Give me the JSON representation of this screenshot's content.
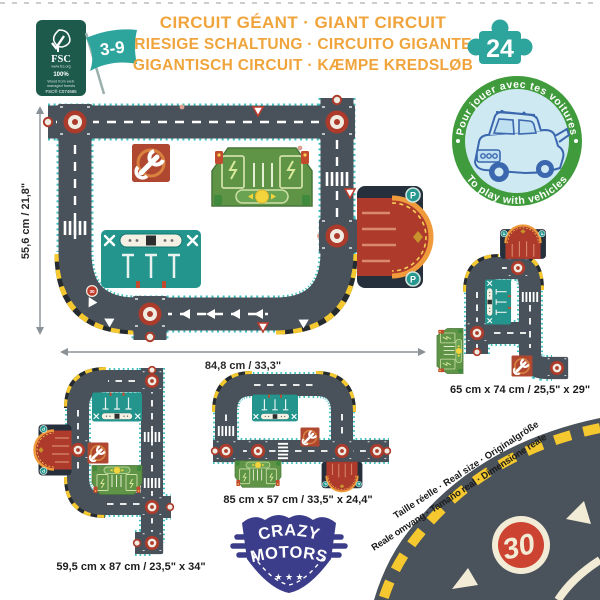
{
  "header": {
    "titles": {
      "line1": "CIRCUIT GÉANT · GIANT CIRCUIT",
      "line2": "RIESIGE SCHALTUNG · CIRCUITO GIGANTE",
      "line3": "GIGANTISCH CIRCUIT · KÆMPE KREDSLØB"
    },
    "age_range": "3-9",
    "piece_count": "24",
    "fsc": {
      "brand": "FSC",
      "site": "www.fsc.org",
      "percent": "100%",
      "claim1": "Wood from well-",
      "claim2": "managed forests",
      "license": "FSC® C074685"
    }
  },
  "vehicles_badge": {
    "top_text": "Pour jouer avec tes voitures",
    "bottom_text": "To play with vehicles"
  },
  "main_circuit": {
    "height_label": "55,6 cm / 21,8\"",
    "width_label": "84,8 cm / 33,3\""
  },
  "variants": {
    "right": {
      "size_label": "65 cm x 74 cm / 25,5\" x 29\""
    },
    "middle": {
      "size_label": "85 cm x 57 cm / 33,5\" x 24,4\""
    },
    "left": {
      "size_label": "59,5 cm x 87 cm / 23,5\" x 34\""
    }
  },
  "tiles": {
    "parking_label": "P",
    "curve_speed_sign": "30"
  },
  "real_size_banner": {
    "line1": "Taille réelle · Real size · Originalgröße",
    "line2": "Reale omvang · Tamaño real · Dimensione reale",
    "speed_sign": "30"
  },
  "logo": {
    "line1": "CRAZY",
    "line2": "MOTORS",
    "stars": "★ ★ ★"
  },
  "colors": {
    "title_orange": "#f0a43c",
    "teal": "#2da59d",
    "badge_green": "#3f9b3b",
    "road": "#49525b",
    "road_edge_teal": "#3fc1bd",
    "hazard_yellow": "#f4c82e",
    "tile_red": "#b04730",
    "tile_green": "#5f9447",
    "tile_teal": "#23958d",
    "parking_navy": "#26303d",
    "parking_red": "#ae3a2c",
    "logo_indigo": "#3b3d8a",
    "fsc_green": "#1d5a4b",
    "sign_red": "#cc4431",
    "cream": "#f2ecd7"
  }
}
